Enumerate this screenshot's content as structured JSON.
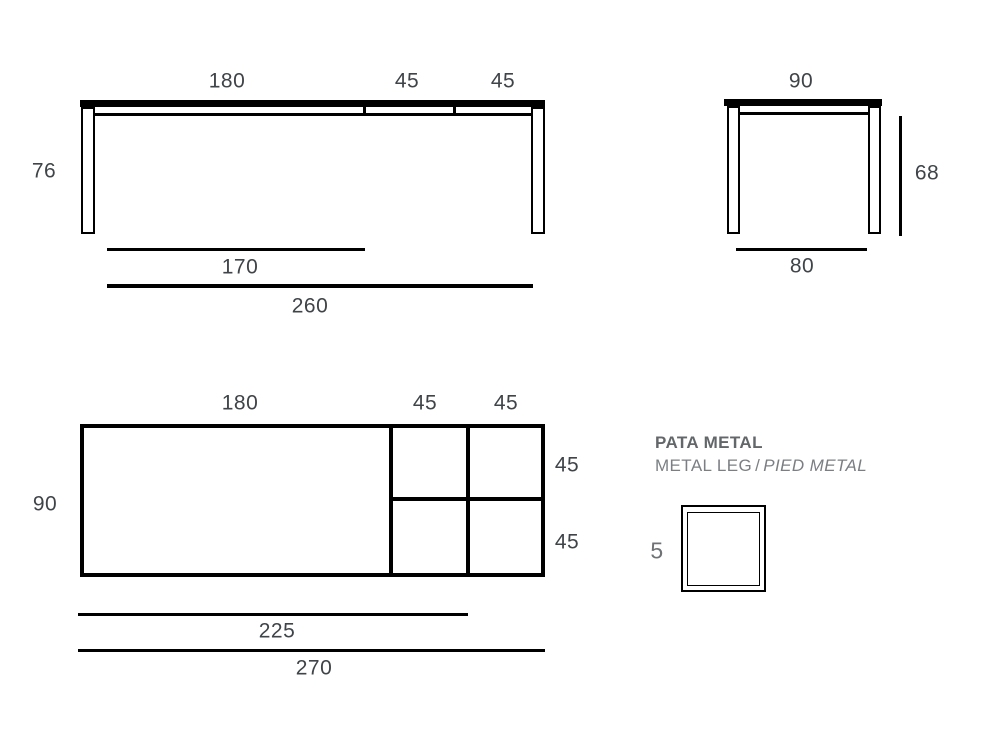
{
  "front_view": {
    "top_dims": [
      "180",
      "45",
      "45"
    ],
    "height": "76",
    "inner_length": "170",
    "total_length": "260"
  },
  "side_view": {
    "top_width": "90",
    "height": "68",
    "leg_span": "80"
  },
  "plan_view": {
    "top_dims": [
      "180",
      "45",
      "45"
    ],
    "depth": "90",
    "right_dims": [
      "45",
      "45"
    ],
    "inner_length": "225",
    "total_length": "270"
  },
  "leg_detail": {
    "title": "PATA METAL",
    "label_en": "METAL LEG",
    "separator": "/",
    "label_fr": "PIED METAL",
    "thickness": "5"
  },
  "colors": {
    "line": "#000000",
    "dimension_text": "#3f4448",
    "leg_title_text": "#63676a",
    "leg_subtitle_text": "#7b7f83"
  }
}
